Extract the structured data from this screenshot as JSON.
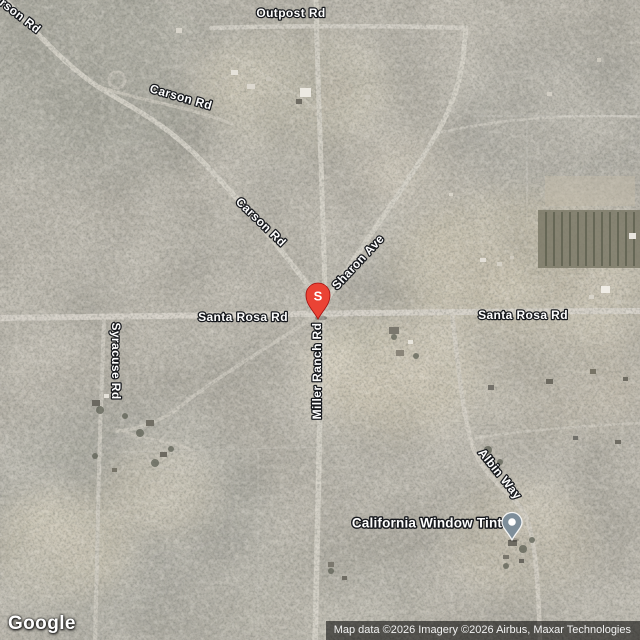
{
  "map": {
    "road_labels": [
      {
        "id": "carson-rd-edge",
        "text": "Carson Rd"
      },
      {
        "id": "outpost-rd",
        "text": "Outpost Rd"
      },
      {
        "id": "carson-rd-upper",
        "text": "Carson Rd"
      },
      {
        "id": "carson-rd-lower",
        "text": "Carson Rd"
      },
      {
        "id": "sharon-ave",
        "text": "Sharon Ave"
      },
      {
        "id": "santa-rosa-rd-west",
        "text": "Santa Rosa Rd"
      },
      {
        "id": "santa-rosa-rd-east",
        "text": "Santa Rosa Rd"
      },
      {
        "id": "syracuse-rd",
        "text": "Syracuse Rd"
      },
      {
        "id": "miller-ranch-rd",
        "text": "Miller Ranch Rd"
      },
      {
        "id": "albin-way",
        "text": "Albin Way"
      }
    ],
    "poi": {
      "name": "California Window Tint"
    },
    "search_marker": {
      "letter": "S",
      "color": "#EA4335",
      "outline": "#A50E0E"
    },
    "poi_marker": {
      "color": "#7E8E9A"
    }
  },
  "footer": {
    "logo_text": "Google",
    "attribution": "Map data ©2026 Imagery ©2026 Airbus, Maxar Technologies"
  }
}
